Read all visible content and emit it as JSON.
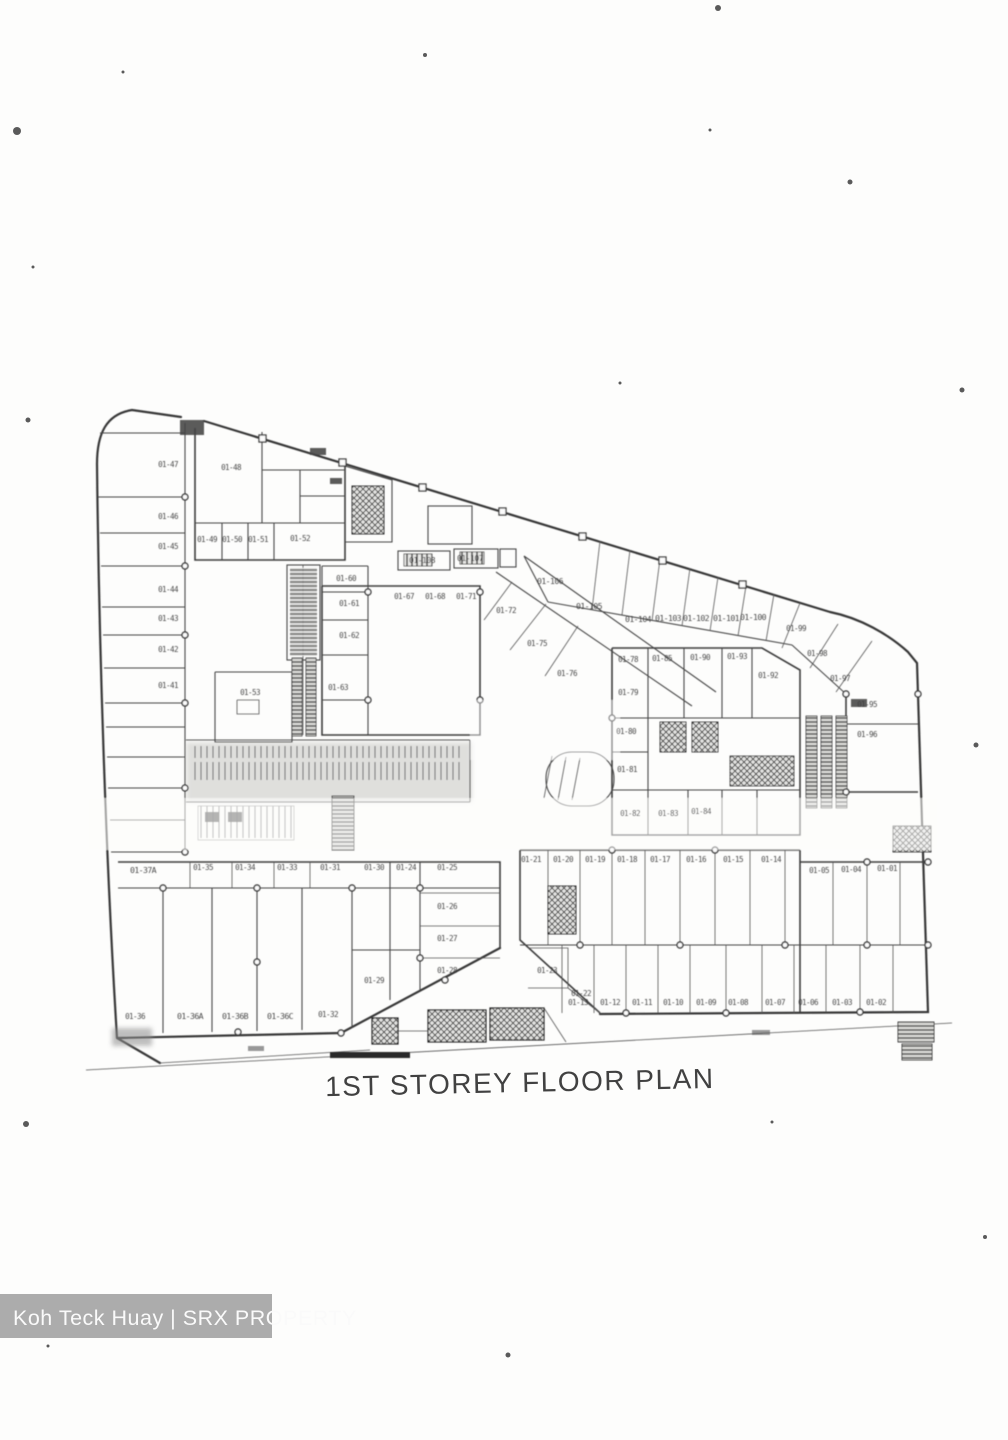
{
  "document": {
    "title": "1ST STOREY FLOOR PLAN",
    "watermark": "Koh Teck Huay | SRX PROPERTY"
  },
  "floor_plan": {
    "units": [
      {
        "label": "01-47",
        "x": 168,
        "y": 467
      },
      {
        "label": "01-46",
        "x": 168,
        "y": 519
      },
      {
        "label": "01-45",
        "x": 168,
        "y": 549
      },
      {
        "label": "01-44",
        "x": 168,
        "y": 592
      },
      {
        "label": "01-43",
        "x": 168,
        "y": 621
      },
      {
        "label": "01-42",
        "x": 168,
        "y": 652
      },
      {
        "label": "01-41",
        "x": 168,
        "y": 688
      },
      {
        "label": "01-48",
        "x": 231,
        "y": 470
      },
      {
        "label": "01-49",
        "x": 207,
        "y": 542
      },
      {
        "label": "01-50",
        "x": 232,
        "y": 542
      },
      {
        "label": "01-51",
        "x": 258,
        "y": 542
      },
      {
        "label": "01-52",
        "x": 300,
        "y": 541
      },
      {
        "label": "01-53",
        "x": 250,
        "y": 695
      },
      {
        "label": "01-60",
        "x": 346,
        "y": 581
      },
      {
        "label": "01-61",
        "x": 349,
        "y": 606
      },
      {
        "label": "01-62",
        "x": 349,
        "y": 638
      },
      {
        "label": "01-63",
        "x": 338,
        "y": 690
      },
      {
        "label": "01-67",
        "x": 404,
        "y": 599
      },
      {
        "label": "01-68",
        "x": 435,
        "y": 599
      },
      {
        "label": "01-71",
        "x": 466,
        "y": 599
      },
      {
        "label": "01-72",
        "x": 506,
        "y": 613
      },
      {
        "label": "01-75",
        "x": 537,
        "y": 646
      },
      {
        "label": "01-76",
        "x": 567,
        "y": 676
      },
      {
        "label": "01-106",
        "x": 550,
        "y": 584
      },
      {
        "label": "01-105",
        "x": 589,
        "y": 609
      },
      {
        "label": "01-104",
        "x": 638,
        "y": 622
      },
      {
        "label": "01-103",
        "x": 668,
        "y": 621
      },
      {
        "label": "01-102",
        "x": 696,
        "y": 621
      },
      {
        "label": "01-101",
        "x": 726,
        "y": 621
      },
      {
        "label": "01-100",
        "x": 753,
        "y": 620
      },
      {
        "label": "01-99",
        "x": 796,
        "y": 631
      },
      {
        "label": "01-98",
        "x": 817,
        "y": 656
      },
      {
        "label": "01-97",
        "x": 840,
        "y": 681
      },
      {
        "label": "01-95",
        "x": 867,
        "y": 707
      },
      {
        "label": "01-96",
        "x": 867,
        "y": 737
      },
      {
        "label": "01-108",
        "x": 422,
        "y": 563
      },
      {
        "label": "01-107",
        "x": 470,
        "y": 561
      },
      {
        "label": "01-78",
        "x": 628,
        "y": 662
      },
      {
        "label": "01-85",
        "x": 662,
        "y": 661
      },
      {
        "label": "01-90",
        "x": 700,
        "y": 660
      },
      {
        "label": "01-93",
        "x": 737,
        "y": 659
      },
      {
        "label": "01-92",
        "x": 768,
        "y": 678
      },
      {
        "label": "01-79",
        "x": 628,
        "y": 695
      },
      {
        "label": "01-80",
        "x": 626,
        "y": 734
      },
      {
        "label": "01-81",
        "x": 627,
        "y": 772
      },
      {
        "label": "01-82",
        "x": 630,
        "y": 816
      },
      {
        "label": "01-83",
        "x": 668,
        "y": 816
      },
      {
        "label": "01-84",
        "x": 701,
        "y": 814
      },
      {
        "label": "01-37A",
        "x": 143,
        "y": 873
      },
      {
        "label": "01-35",
        "x": 203,
        "y": 870
      },
      {
        "label": "01-34",
        "x": 245,
        "y": 870
      },
      {
        "label": "01-33",
        "x": 287,
        "y": 870
      },
      {
        "label": "01-31",
        "x": 330,
        "y": 870
      },
      {
        "label": "01-30",
        "x": 374,
        "y": 870
      },
      {
        "label": "01-24",
        "x": 406,
        "y": 870
      },
      {
        "label": "01-25",
        "x": 447,
        "y": 870
      },
      {
        "label": "01-26",
        "x": 447,
        "y": 909
      },
      {
        "label": "01-27",
        "x": 447,
        "y": 941
      },
      {
        "label": "01-28",
        "x": 447,
        "y": 973
      },
      {
        "label": "01-29",
        "x": 374,
        "y": 983
      },
      {
        "label": "01-36",
        "x": 135,
        "y": 1019
      },
      {
        "label": "01-36A",
        "x": 190,
        "y": 1019
      },
      {
        "label": "01-36B",
        "x": 235,
        "y": 1019
      },
      {
        "label": "01-36C",
        "x": 280,
        "y": 1019
      },
      {
        "label": "01-32",
        "x": 328,
        "y": 1017
      },
      {
        "label": "01-21",
        "x": 531,
        "y": 862
      },
      {
        "label": "01-20",
        "x": 563,
        "y": 862
      },
      {
        "label": "01-19",
        "x": 595,
        "y": 862
      },
      {
        "label": "01-18",
        "x": 627,
        "y": 862
      },
      {
        "label": "01-17",
        "x": 660,
        "y": 862
      },
      {
        "label": "01-16",
        "x": 696,
        "y": 862
      },
      {
        "label": "01-15",
        "x": 733,
        "y": 862
      },
      {
        "label": "01-14",
        "x": 771,
        "y": 862
      },
      {
        "label": "01-23",
        "x": 547,
        "y": 973
      },
      {
        "label": "01-22",
        "x": 581,
        "y": 996
      },
      {
        "label": "01-13",
        "x": 578,
        "y": 1005
      },
      {
        "label": "01-12",
        "x": 610,
        "y": 1005
      },
      {
        "label": "01-11",
        "x": 642,
        "y": 1005
      },
      {
        "label": "01-10",
        "x": 673,
        "y": 1005
      },
      {
        "label": "01-09",
        "x": 706,
        "y": 1005
      },
      {
        "label": "01-08",
        "x": 738,
        "y": 1005
      },
      {
        "label": "01-07",
        "x": 775,
        "y": 1005
      },
      {
        "label": "01-06",
        "x": 808,
        "y": 1005
      },
      {
        "label": "01-05",
        "x": 819,
        "y": 873
      },
      {
        "label": "01-04",
        "x": 851,
        "y": 872
      },
      {
        "label": "01-01",
        "x": 887,
        "y": 871
      },
      {
        "label": "01-03",
        "x": 842,
        "y": 1005
      },
      {
        "label": "01-02",
        "x": 876,
        "y": 1005
      }
    ]
  }
}
